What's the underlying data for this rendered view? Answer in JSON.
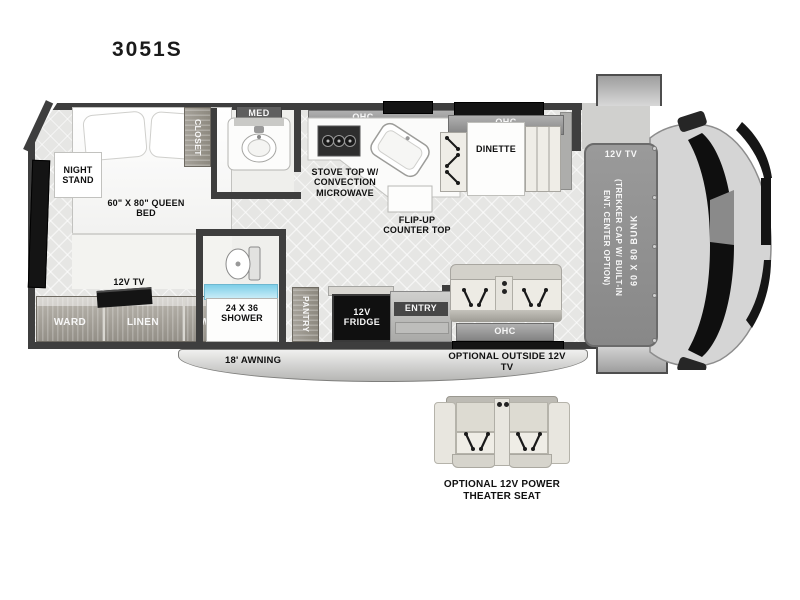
{
  "title": "3051S",
  "bedroom": {
    "night_stand": "NIGHT STAND",
    "queen_bed": "60\" X 80\" QUEEN BED",
    "tv": "12V TV",
    "ward_left": "WARD",
    "linen": "LINEN",
    "ward_right": "WARD",
    "closet": "CLOSET"
  },
  "bath": {
    "med": "MED",
    "shower": "24 X 36 SHOWER"
  },
  "kitchen": {
    "ohc": "OHC",
    "stove": "STOVE TOP W/ CONVECTION MICROWAVE",
    "flip_up": "FLIP-UP COUNTER TOP",
    "pantry": "PANTRY",
    "fridge": "12V FRIDGE"
  },
  "dinette": {
    "ohc": "OHC",
    "label": "DINETTE"
  },
  "living": {
    "entry": "ENTRY",
    "ohc": "OHC"
  },
  "cab": {
    "tv": "12V TV",
    "cap_note": "(TREKKER CAP W/ BUILT-IN ENT. CENTER OPTION)",
    "bunk": "60 X 80 BUNK"
  },
  "exterior": {
    "awning": "18' AWNING",
    "outside_tv": "OPTIONAL OUTSIDE 12V TV"
  },
  "options": {
    "theater_seat": "OPTIONAL 12V POWER THEATER SEAT"
  },
  "colors": {
    "wall": "#3e3e3e",
    "floor": "#e6e6e4",
    "wood": "#9c978f",
    "shower_glass": "#8fd4ea",
    "window": "#141414"
  }
}
